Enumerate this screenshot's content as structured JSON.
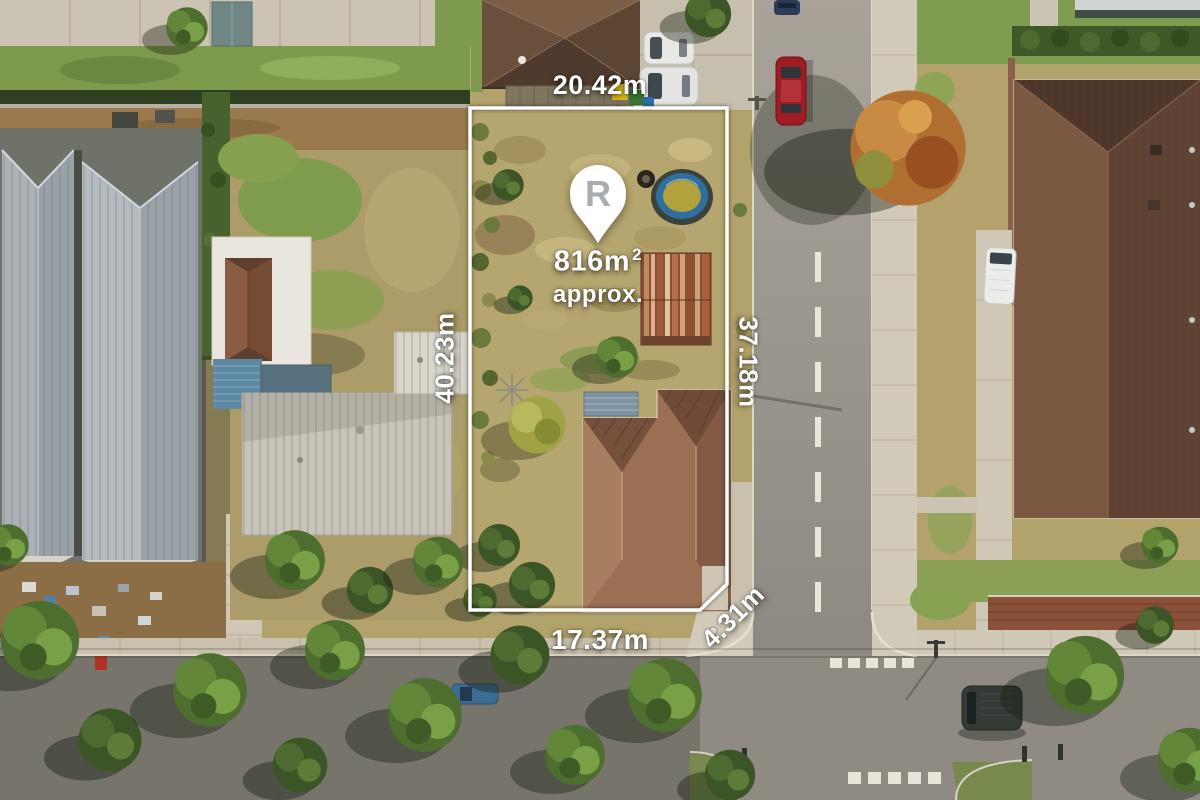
{
  "annotations": {
    "frontage_top": "20.42m",
    "side_left": "40.23m",
    "side_right": "37.18m",
    "frontage_bottom": "17.37m",
    "corner_splay": "4.31m",
    "area_value": "816m",
    "area_superscript": "2",
    "area_qualifier": "approx.",
    "pin_logo_letter": "R"
  },
  "colors": {
    "boundary": "#ffffff",
    "label_text": "#ffffff",
    "pin_fill": "#ffffff",
    "pin_logo": "#a7acb0"
  }
}
